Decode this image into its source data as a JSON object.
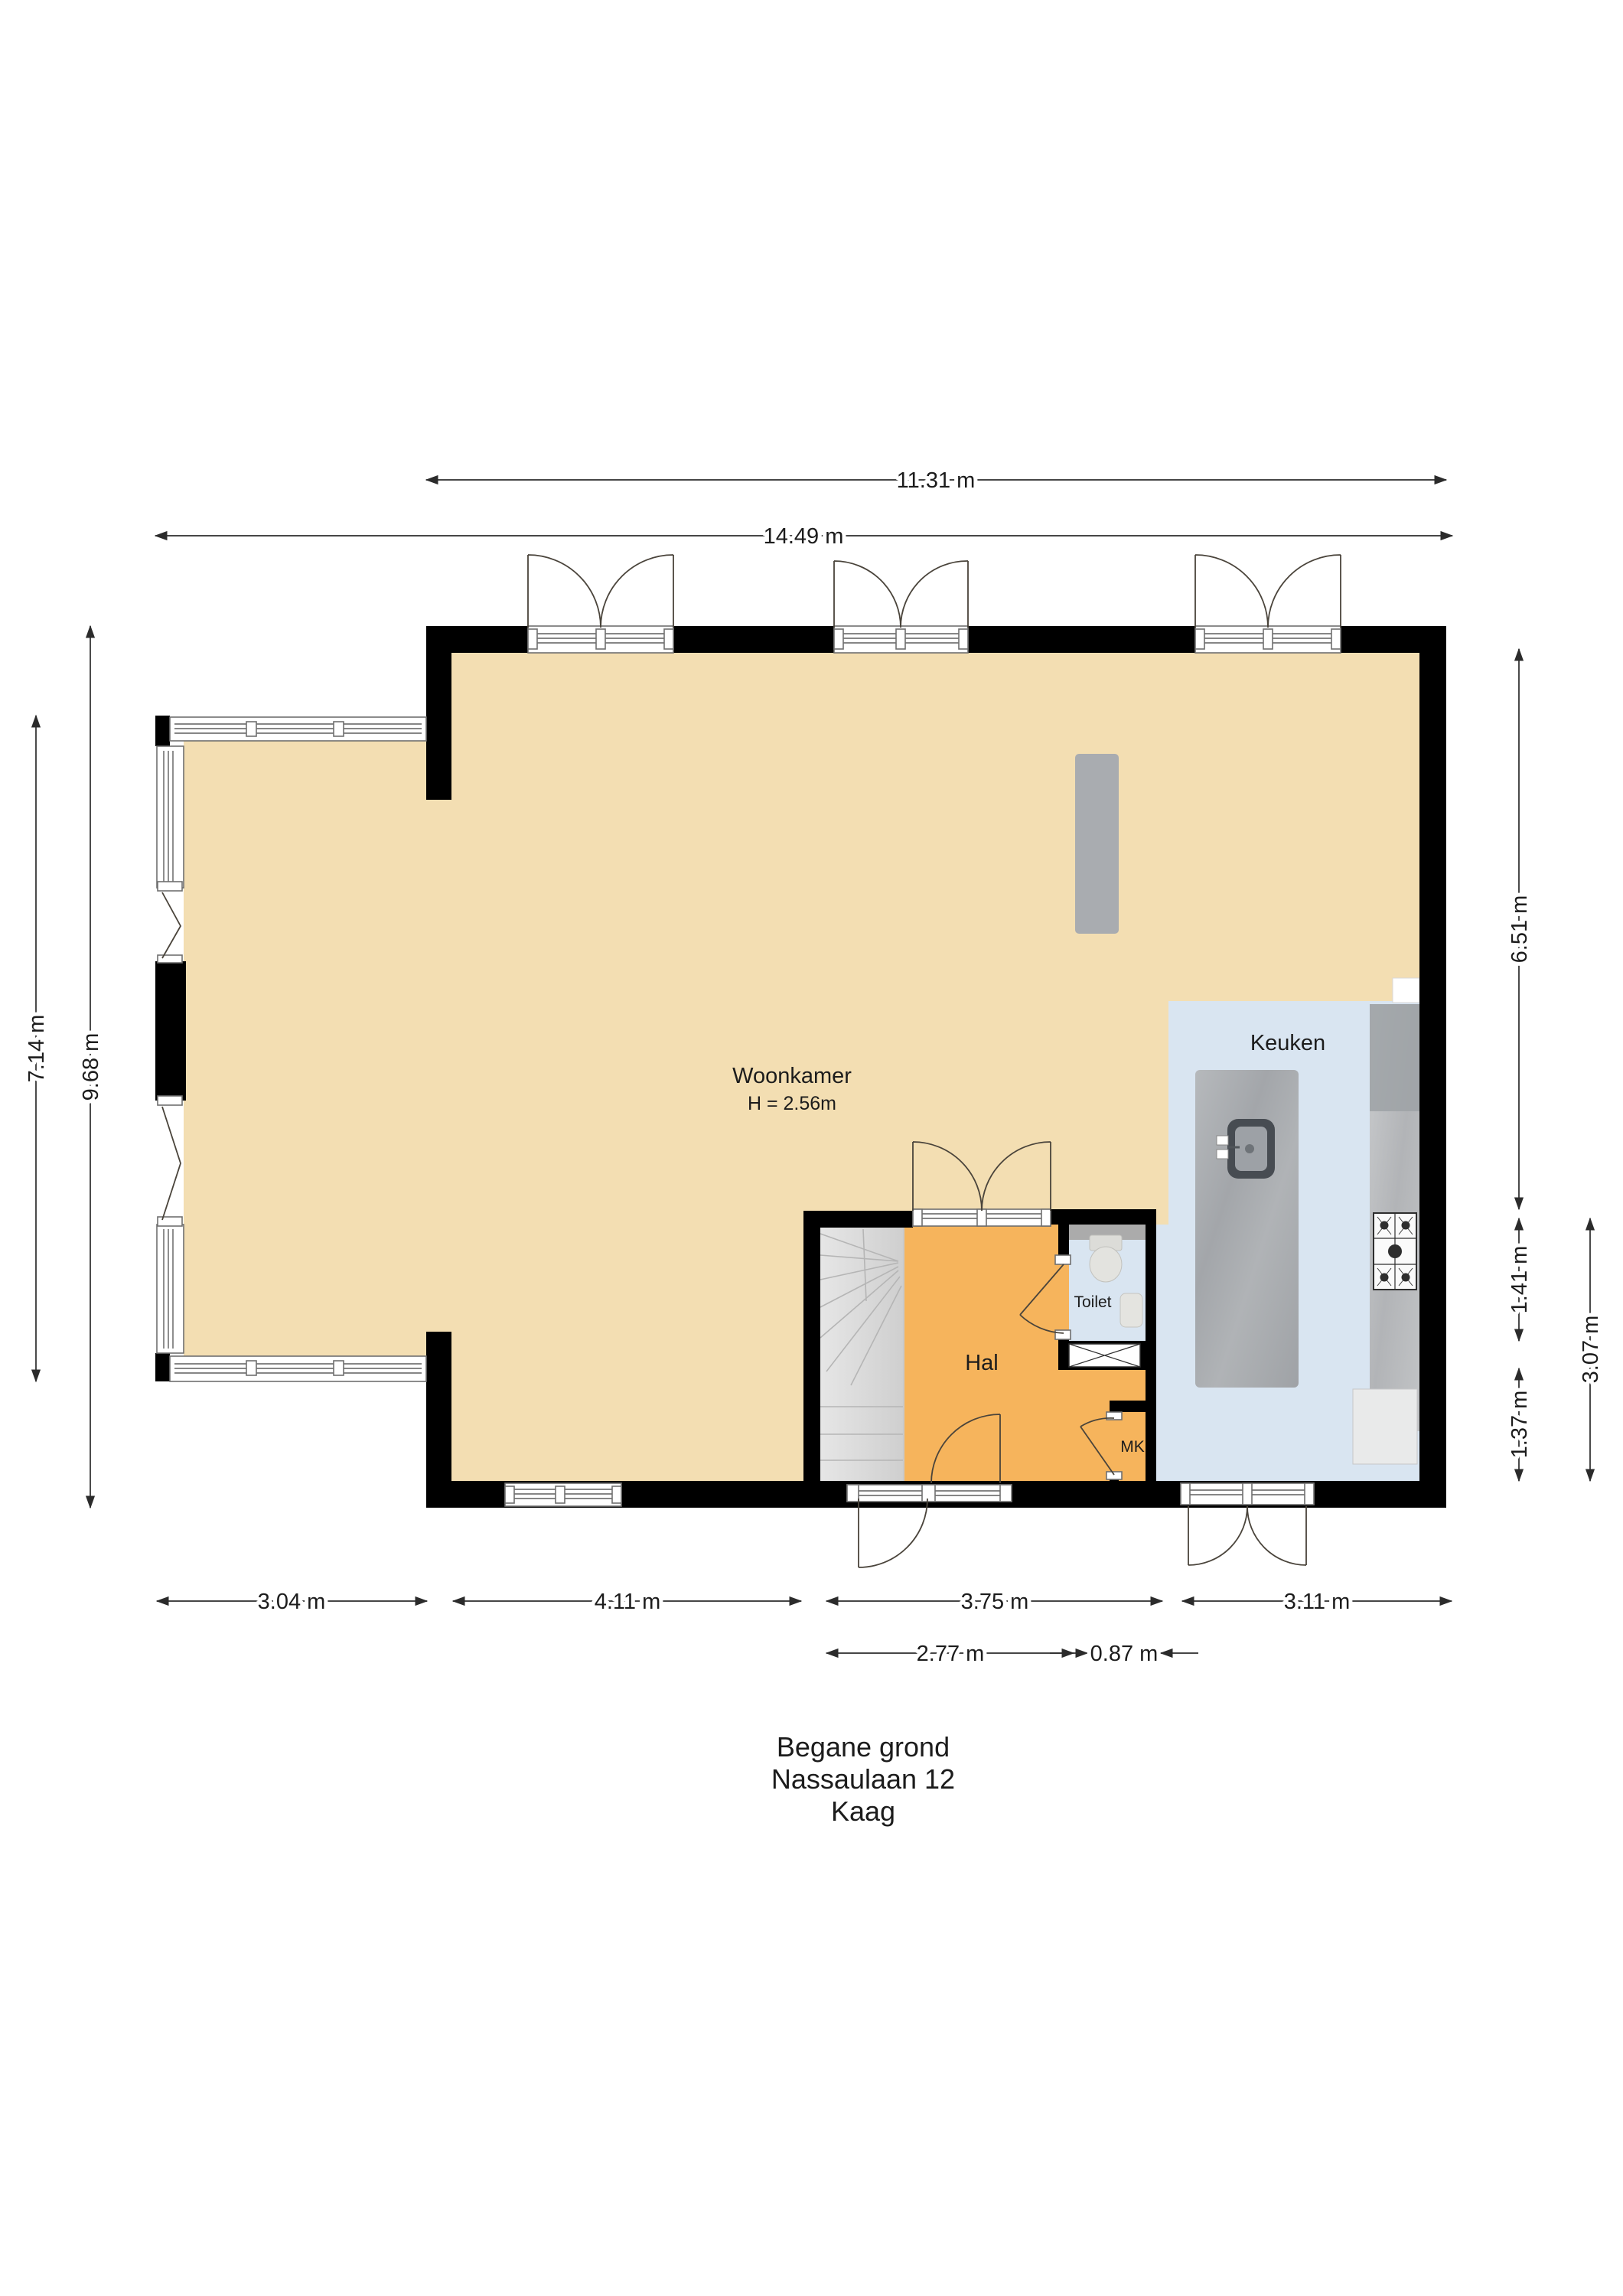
{
  "title": {
    "line1": "Begane grond",
    "line2": "Nassaulaan 12",
    "line3": "Kaag"
  },
  "rooms": {
    "woonkamer": {
      "label": "Woonkamer",
      "height_note": "H = 2.56m"
    },
    "keuken": {
      "label": "Keuken"
    },
    "hal": {
      "label": "Hal"
    },
    "toilet": {
      "label": "Toilet"
    },
    "mk": {
      "label": "MK"
    }
  },
  "dimensions": {
    "top": [
      {
        "label": "11.31 m"
      },
      {
        "label": "14.49 m"
      }
    ],
    "left": [
      {
        "label": "7.14 m"
      },
      {
        "label": "9.68 m"
      }
    ],
    "right": [
      {
        "label": "6.51 m"
      },
      {
        "label": "1.41 m"
      },
      {
        "label": "1.37 m"
      },
      {
        "label": "3.07 m"
      }
    ],
    "bottom": [
      {
        "label": "3.04 m"
      },
      {
        "label": "4.11 m"
      },
      {
        "label": "3.75 m"
      },
      {
        "label": "3.11 m"
      },
      {
        "label": "2.77 m"
      },
      {
        "label": "0.87 m"
      }
    ]
  },
  "colors": {
    "wall": "#000000",
    "floor_living": "#F3DEB2",
    "floor_hall": "#F6B45C",
    "floor_kitchen": "#D9E5F1",
    "floor_toilet": "#D9E5F1",
    "toilet_shelf": "#ABABAB",
    "stairs": "#DCDCDC",
    "island_counter": "#A9ACB0",
    "appliance": "#E9EAEA",
    "dimension_text": "#1C1C1C"
  }
}
